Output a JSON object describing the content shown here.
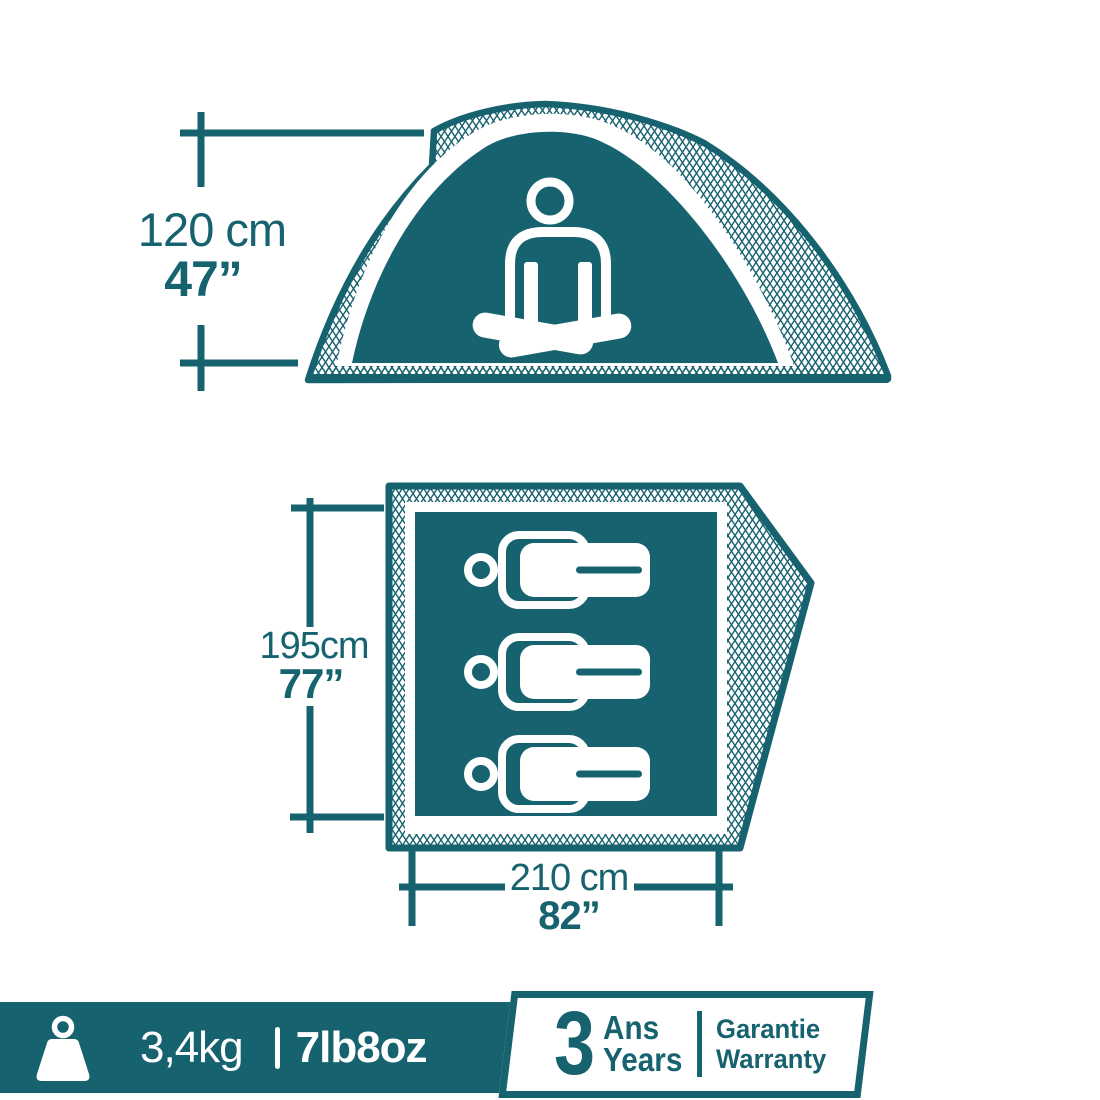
{
  "colors": {
    "teal": "#17626F",
    "background": "#FFFFFF"
  },
  "tent_side_view": {
    "height": {
      "metric": "120 cm",
      "imperial": "47”"
    }
  },
  "floor_plan": {
    "people_capacity": 3,
    "depth": {
      "metric": "195cm",
      "imperial": "77”"
    },
    "width": {
      "metric": "210 cm",
      "imperial": "82”"
    }
  },
  "footer": {
    "weight": {
      "metric": "3,4kg",
      "separator": "|",
      "imperial": "7lb8oz"
    },
    "warranty": {
      "duration": "3",
      "unit_fr": "Ans",
      "unit_en": "Years",
      "label_fr": "Garantie",
      "label_en": "Warranty"
    }
  }
}
